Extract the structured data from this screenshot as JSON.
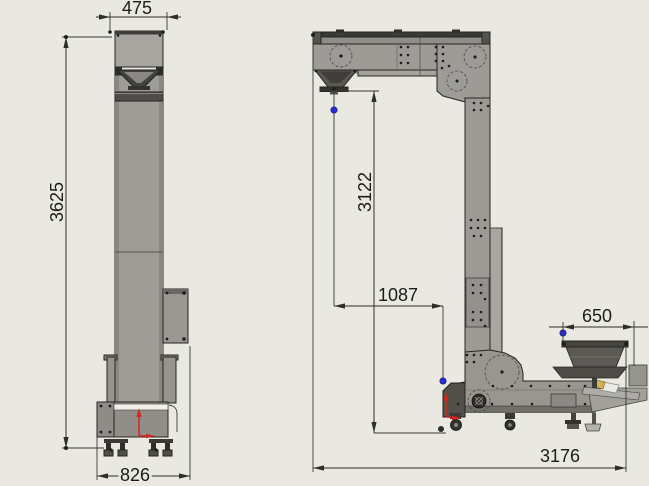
{
  "dims": {
    "front_top_width": "475",
    "front_height": "3625",
    "front_base_width": "826",
    "side_drop_height": "3122",
    "side_offset": "1087",
    "side_infeed_width": "650",
    "side_total_length": "3176"
  },
  "colors": {
    "background": "#e9e8e1",
    "machine_gray": "#9c9a94",
    "marker_blue": "#2b2be0",
    "axis_red": "#d3261d"
  }
}
